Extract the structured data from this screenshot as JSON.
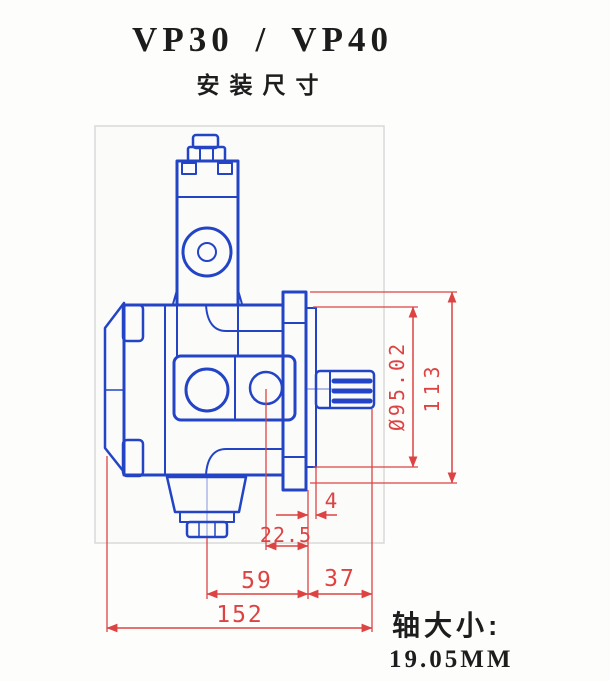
{
  "header": {
    "title": "VP30 / VP40",
    "subtitle": "安装尺寸"
  },
  "drawing": {
    "kind": "vane-pump-mounting-dimension-drawing",
    "unit": "mm",
    "colors": {
      "geometry_blue": "#2345c5",
      "dimension_red": "#dd4343",
      "frame_gray": "#d9d9d9"
    },
    "dims": {
      "pilot_diameter": "Ø95.02",
      "overall_height": "113",
      "spigot_depth": "4",
      "outlet_to_mounting_face": "22.5",
      "inlet_to_mounting_face": "59",
      "mounting_face_to_shaft_end": "37",
      "overall_length": "152"
    }
  },
  "footer": {
    "shaft_label": "轴大小:",
    "shaft_value": "19.05MM"
  }
}
